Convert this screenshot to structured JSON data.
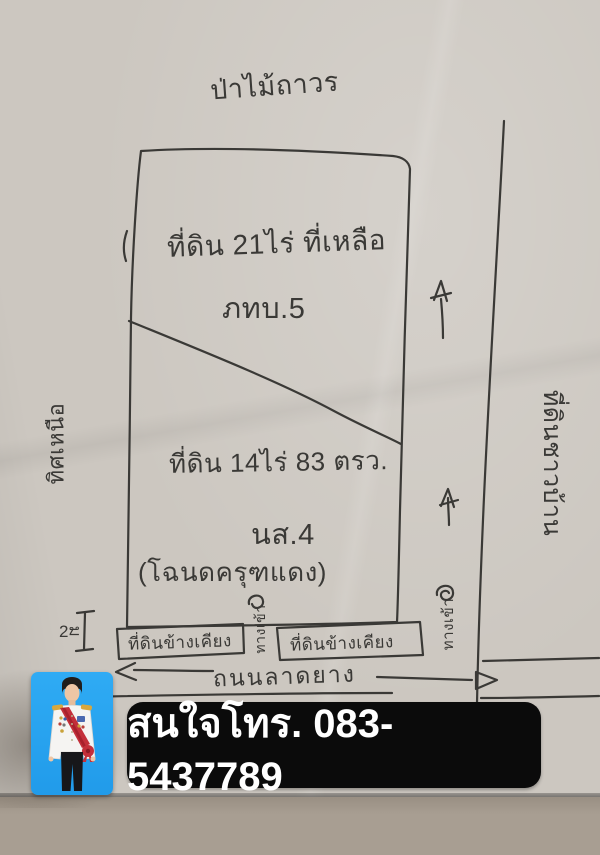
{
  "page": {
    "paper_color": "#ccc7c0",
    "ink_color": "#3a3936",
    "bottom_surface_color": "#a89e92"
  },
  "sketch": {
    "top_label": "ป่าไม้ถาวร",
    "parcel_upper": {
      "line1": "ที่ดิน 21ไร่ ที่เหลือ",
      "line2": "ภทบ.5"
    },
    "parcel_lower": {
      "line1": "ที่ดิน 14ไร่ 83 ตรว.",
      "line2": "นส.4",
      "line3": "(โฉนดครุฑแดง)"
    },
    "left_side_label": "ทิศเหนือ",
    "right_side_label": "ที่ดินชาวบ้าน",
    "adjacent_plot_left": "ที่ดินข้างเคียง",
    "adjacent_plot_right": "ที่ดินข้างเคียง",
    "entrance_label_middle": "ทางเข้า",
    "entrance_label_right": "ทางเข้า",
    "road_label": "ถนนลาดยาง",
    "dimension_label_number": "2",
    "dimension_label_unit": "ม"
  },
  "contact": {
    "banner_text": "สนใจโทร. 083-5437789",
    "banner_background": "#0b0b0b",
    "banner_text_color": "#ffffff"
  },
  "photo": {
    "background_color": "#2fabf4"
  }
}
